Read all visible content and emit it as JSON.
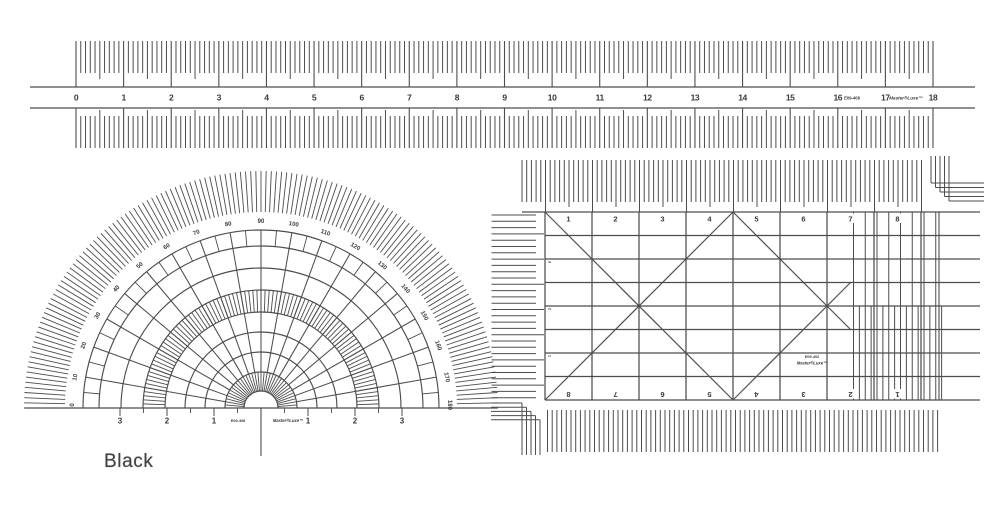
{
  "meta": {
    "color_label": "Black"
  },
  "colors": {
    "ink": "#4d4d4d",
    "ink_dark": "#3a3a3a",
    "background": "#ffffff"
  },
  "ruler": {
    "numbers": [
      "0",
      "1",
      "2",
      "3",
      "4",
      "5",
      "6",
      "7",
      "8",
      "9",
      "10",
      "11",
      "12",
      "13",
      "14",
      "15",
      "16",
      "17",
      "18"
    ],
    "code": "E09-408",
    "brand": "Master®Luxe™"
  },
  "protractor": {
    "degree_labels": [
      "180",
      "170",
      "160",
      "150",
      "140",
      "130",
      "120",
      "110",
      "100",
      "90",
      "80",
      "70",
      "60",
      "50",
      "40",
      "30",
      "20",
      "10",
      "0"
    ],
    "scale_numbers_left": [
      "3",
      "2",
      "1"
    ],
    "scale_numbers_right": [
      "1",
      "2",
      "3"
    ],
    "code": "E09-408",
    "brand": "Master®Luxe™"
  },
  "grid": {
    "top_numbers": [
      "1",
      "2",
      "3",
      "4",
      "5",
      "6",
      "7",
      "8"
    ],
    "bottom_numbers": [
      "8",
      "7",
      "6",
      "5",
      "4",
      "3",
      "2",
      "1"
    ],
    "side_numbers": [
      "3",
      "2",
      "1"
    ],
    "code": "E09-402",
    "brand": "Master®Luxe™"
  }
}
